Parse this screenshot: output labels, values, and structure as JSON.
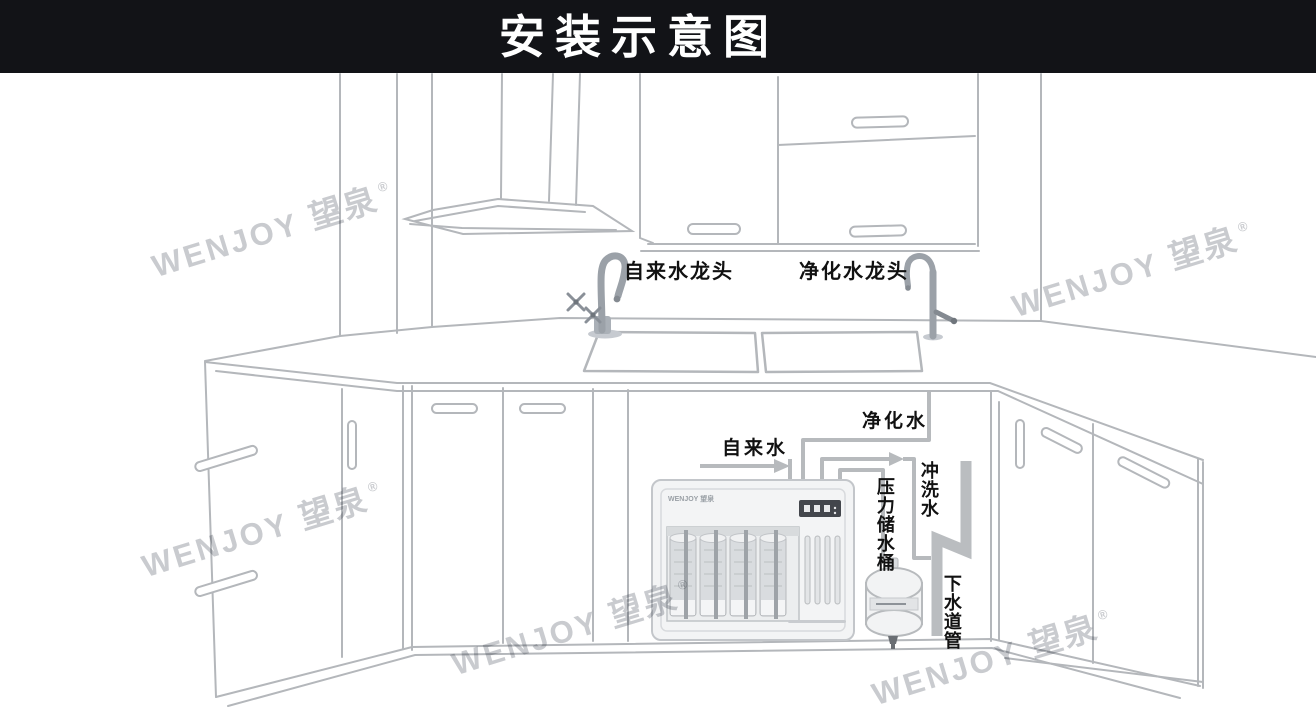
{
  "title": "安装示意图",
  "brand": {
    "latin": "WENJOY",
    "cjk": "望泉",
    "reg": "®"
  },
  "labels": {
    "tap_faucet": "自来水龙头",
    "pure_faucet": "净化水龙头",
    "tap_water": "自来水",
    "pure_water": "净化水",
    "flush_water": "冲洗水",
    "pressure_tank": "压力储水桶",
    "drain_pipe": "下水道管"
  },
  "device": {
    "brand_text": "WENJOY 望泉"
  },
  "colors": {
    "header_bg": "#121317",
    "header_text": "#ffffff",
    "line": "#b4b7bb",
    "pipe": "#b7babd",
    "drain": "#babdc0",
    "label_text": "#111111",
    "watermark": "#c9cbcf"
  }
}
